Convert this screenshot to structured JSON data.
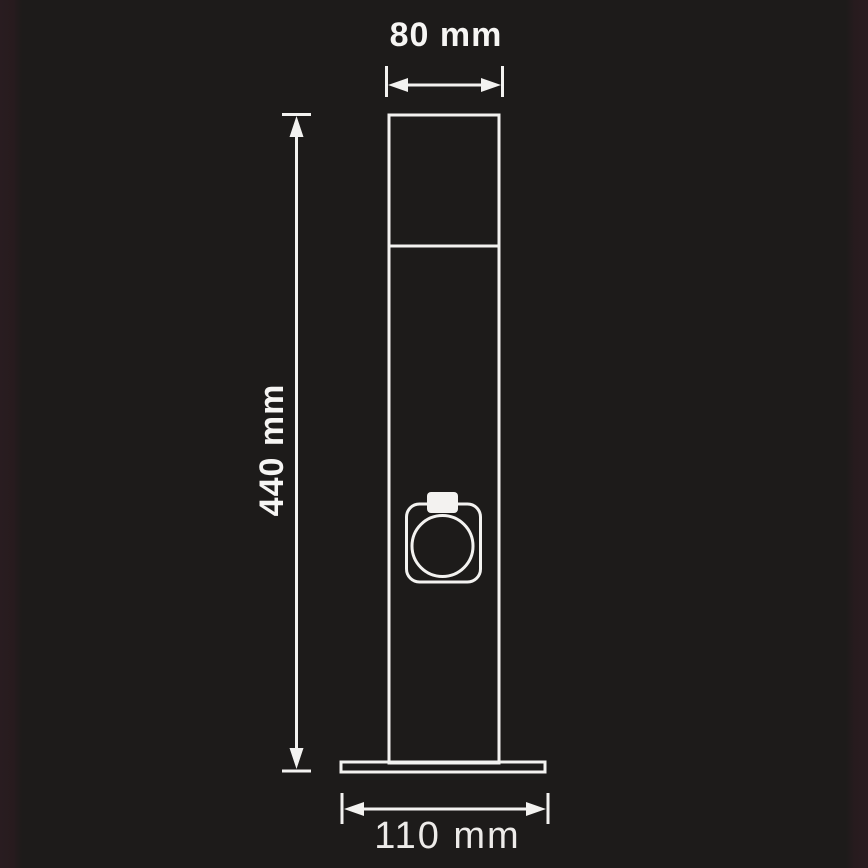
{
  "diagram": {
    "kind": "technical-dimension-drawing",
    "dimensions": {
      "top_width": {
        "label": "80 mm",
        "value": 80,
        "unit": "mm"
      },
      "height": {
        "label": "440 mm",
        "value": 440,
        "unit": "mm"
      },
      "base_width": {
        "label": "110 mm",
        "value": 110,
        "unit": "mm"
      }
    },
    "colors": {
      "background": "#1D1B1A",
      "edge_tint": "#271B1E",
      "line": "#F3F2F0",
      "label_text": "#F6F5F3"
    }
  }
}
